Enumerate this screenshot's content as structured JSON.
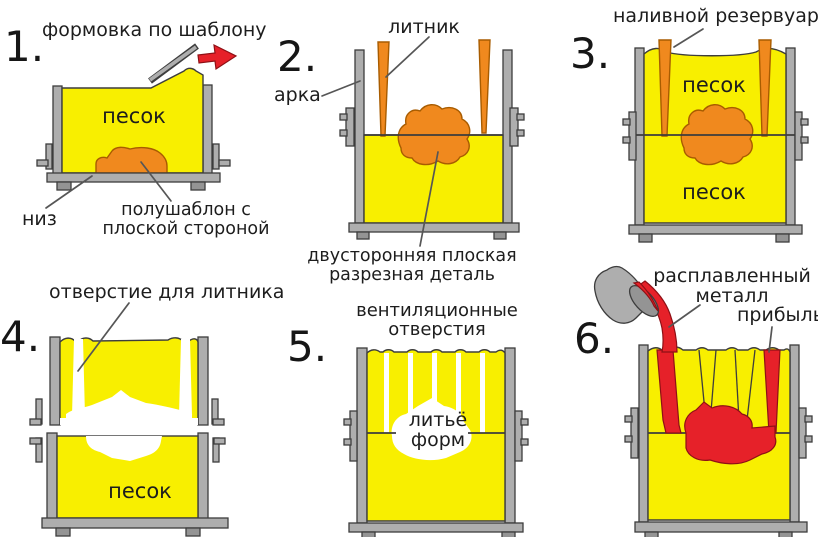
{
  "palette": {
    "background": "#ffffff",
    "sand_yellow": "#f8ef00",
    "pattern_orange": "#f0891e",
    "molten_red": "#e62129",
    "flask_gray": "#aeaeae",
    "flask_gray_dark": "#949494",
    "outline": "#3d3d3d",
    "orange_outline": "#a85c00",
    "red_outline": "#8e1015",
    "leader_gray": "#565656",
    "cavity_white": "#ffffff",
    "text": "#1d1d1d"
  },
  "steps": {
    "s1": {
      "number": "1.",
      "title": "формовка по шаблону",
      "sand": "песок",
      "bottom": "низ",
      "pattern1": "полушаблон с",
      "pattern2": "плоской стороной"
    },
    "s2": {
      "number": "2.",
      "sprue": "литник",
      "arch": "арка",
      "part1": "двусторонняя плоская",
      "part2": "разрезная деталь"
    },
    "s3": {
      "number": "3.",
      "reservoir": "наливной резервуар",
      "sand_top": "песок",
      "sand_bottom": "песок"
    },
    "s4": {
      "number": "4.",
      "hole": "отверстие для литника",
      "sand": "песок"
    },
    "s5": {
      "number": "5.",
      "vents1": "вентиляционные",
      "vents2": "отверстия",
      "cast1": "литьё",
      "cast2": "форм"
    },
    "s6": {
      "number": "6.",
      "metal1": "расплавленный",
      "metal2": "металл",
      "riser": "прибыль"
    }
  }
}
